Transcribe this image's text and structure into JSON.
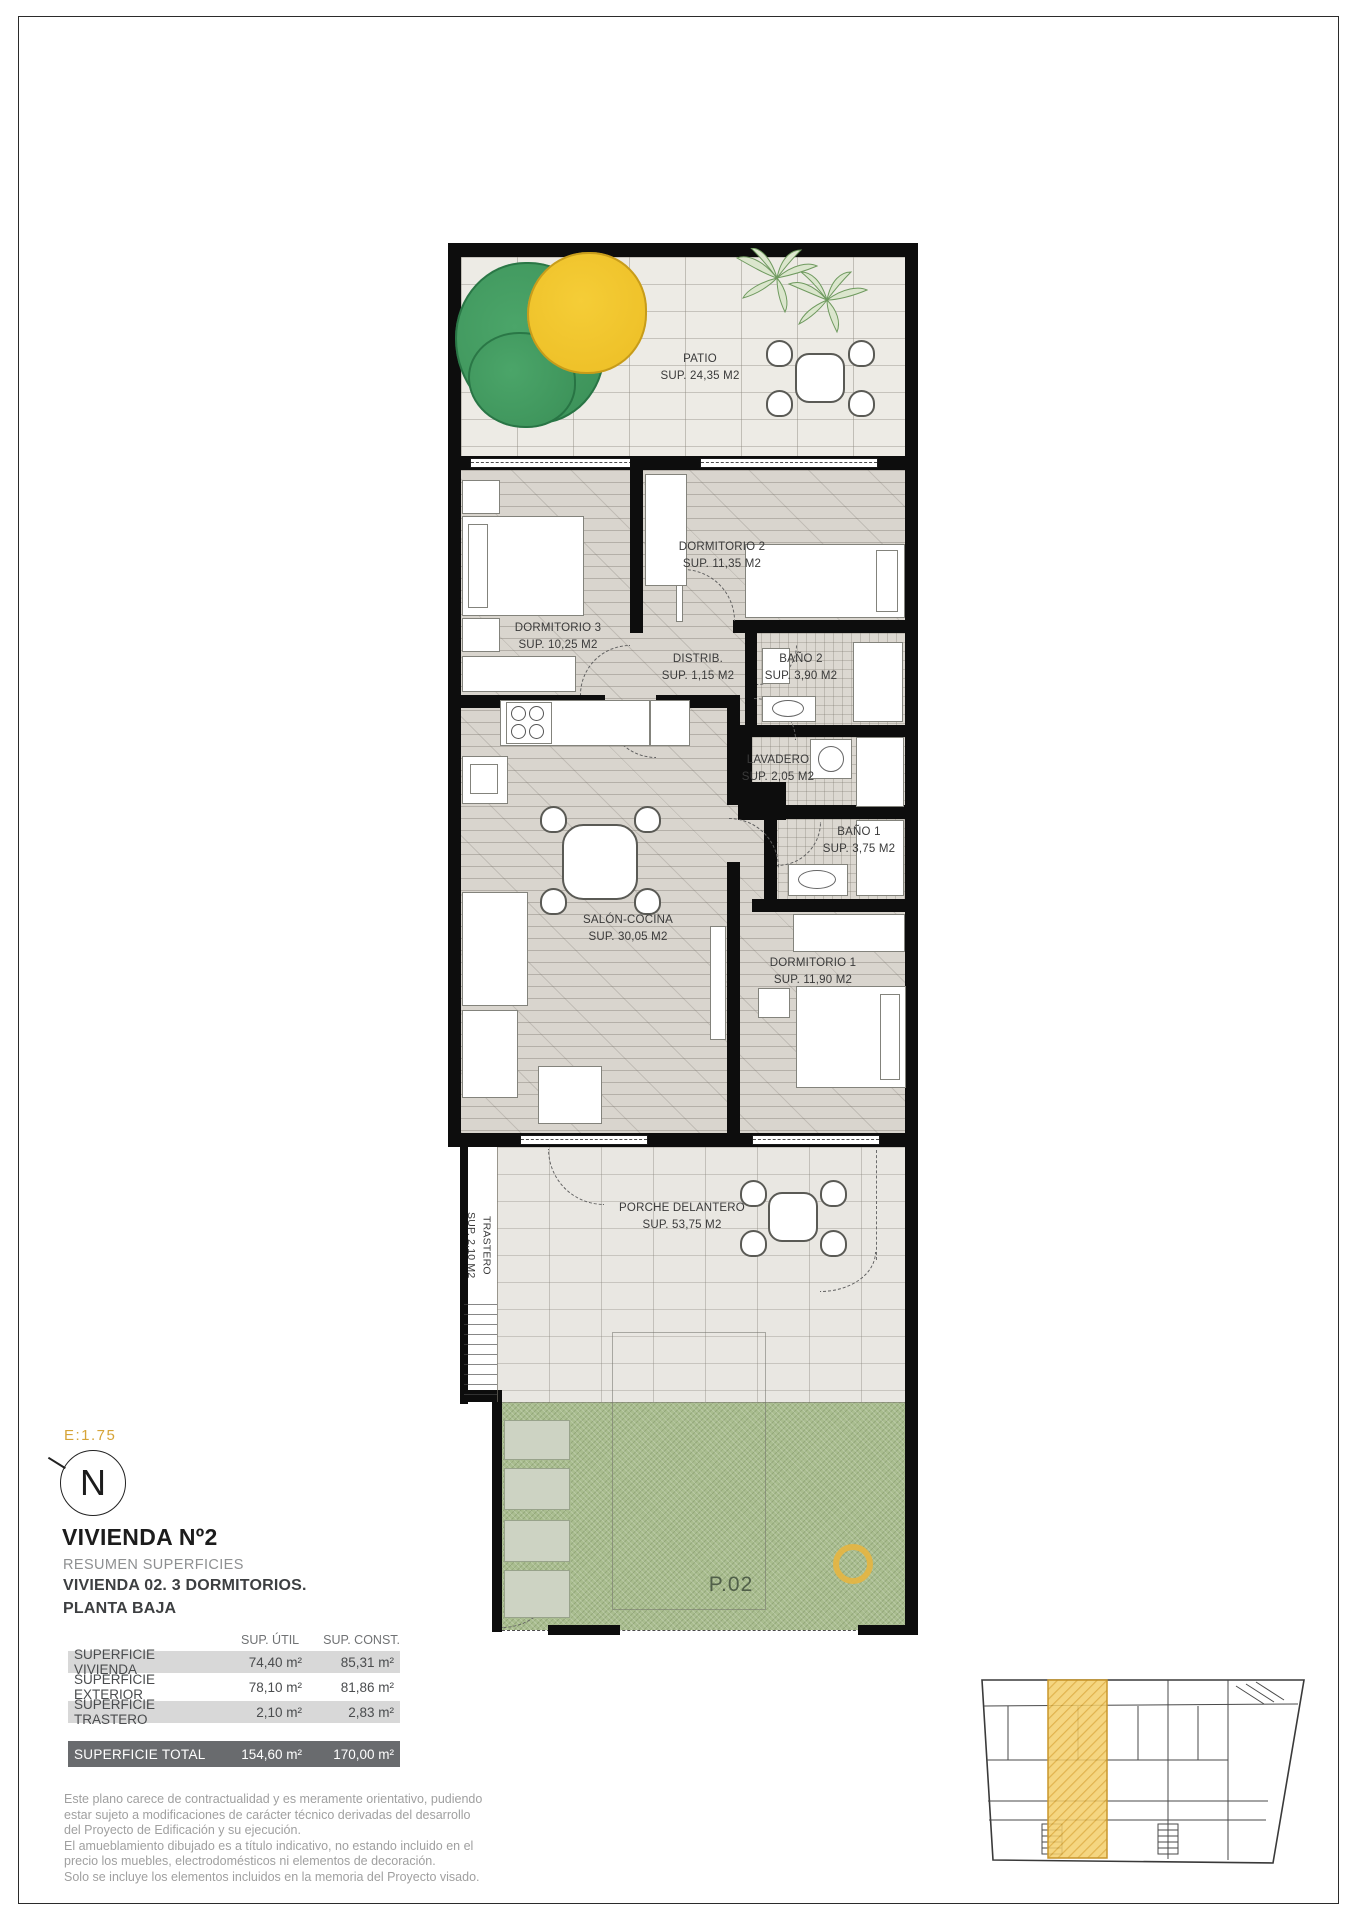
{
  "plan": {
    "scale_label": "E:1.75",
    "compass": "N",
    "parcel_label": "P.02",
    "rooms": {
      "patio": {
        "name": "PATIO",
        "area": "SUP. 24,35 M2"
      },
      "dormitorio2": {
        "name": "DORMITORIO 2",
        "area": "SUP. 11,35 M2"
      },
      "dormitorio3": {
        "name": "DORMITORIO 3",
        "area": "SUP. 10,25 M2"
      },
      "distribuidor": {
        "name": "DISTRIB.",
        "area": "SUP. 1,15 M2"
      },
      "bano2": {
        "name": "BAÑO 2",
        "area": "SUP. 3,90 M2"
      },
      "lavadero": {
        "name": "LAVADERO",
        "area": "SUP. 2,05 M2"
      },
      "bano1": {
        "name": "BAÑO 1",
        "area": "SUP. 3,75 M2"
      },
      "salon": {
        "name": "SALÓN-COCINA",
        "area": "SUP. 30,05 M2"
      },
      "dormitorio1": {
        "name": "DORMITORIO 1",
        "area": "SUP. 11,90 M2"
      },
      "porche": {
        "name": "PORCHE DELANTERO",
        "area": "SUP. 53,75 M2"
      },
      "trastero": {
        "name": "TRASTERO",
        "area": "SUP. 2,10 M2"
      }
    }
  },
  "title_block": {
    "title": "VIVIENDA Nº2",
    "subtitle": "RESUMEN SUPERFICIES",
    "line2": "VIVIENDA 02. 3 DORMITORIOS.",
    "line3": "PLANTA BAJA"
  },
  "area_table": {
    "headers": {
      "util": "SUP. ÚTIL",
      "const": "SUP. CONST."
    },
    "rows": [
      {
        "label": "SUPERFICIE VIVIENDA",
        "util": "74,40 m²",
        "const": "85,31 m²"
      },
      {
        "label": "SUPERFICIE EXTERIOR",
        "util": "78,10 m²",
        "const": "81,86 m²"
      },
      {
        "label": "SUPERFICIE TRASTERO",
        "util": "2,10 m²",
        "const": "2,83 m²"
      }
    ],
    "total": {
      "label": "SUPERFICIE TOTAL",
      "util": "154,60 m²",
      "const": "170,00 m²"
    }
  },
  "disclaimer": {
    "lines": [
      "Este plano carece de contractualidad y es meramente orientativo, pudiendo",
      "estar sujeto a modificaciones de carácter técnico derivadas del desarrollo",
      "del Proyecto de Edificación y su ejecución.",
      "El amueblamiento dibujado es a título indicativo, no estando incluido en el",
      "precio los muebles, electrodomésticos ni elementos de decoración.",
      "Solo se incluye los elementos incluidos en la memoria del Proyecto visado."
    ]
  },
  "colors": {
    "accent": "#D6A438",
    "highlight": "#EDBD4A",
    "garden": "#A9BD8F"
  }
}
